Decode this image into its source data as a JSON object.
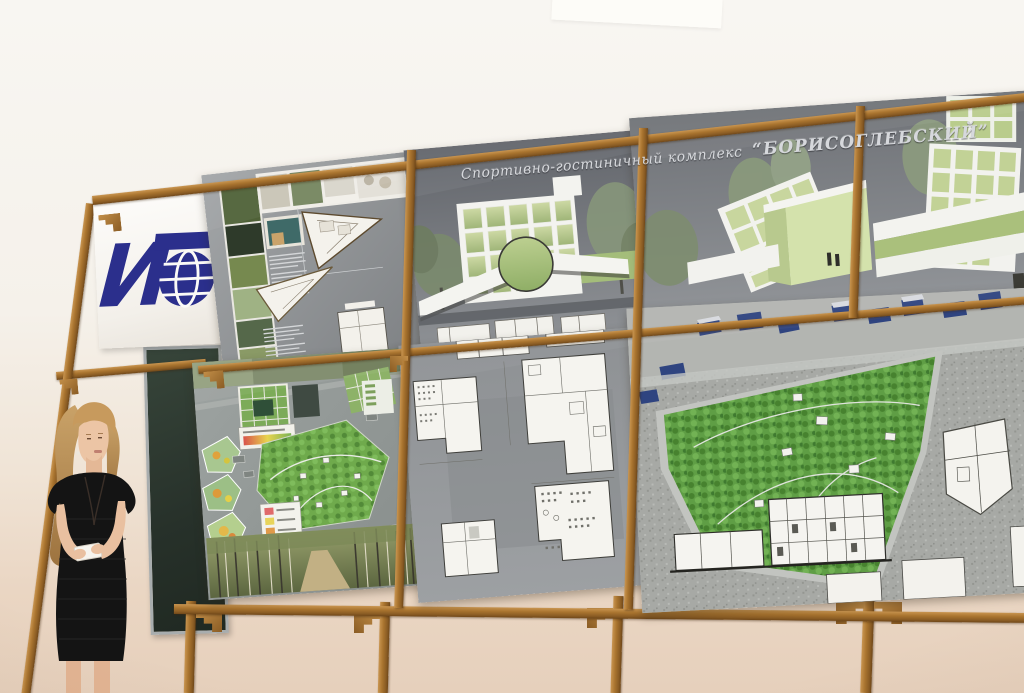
{
  "banner": {
    "title_prefix": "Спортивно-гостиничный комплекс",
    "title_name": "“БОРИСОГЛЕБСКИЙ”"
  },
  "logo": {
    "letter": "И",
    "letters": "ИГ",
    "color": "#2b2f8c"
  },
  "colors": {
    "wood": "#a9742f",
    "wall_top": "#f8f6f2",
    "wall_bottom": "#e6d0bc",
    "board_gray": "#85888c",
    "park_green": "#5f9e45",
    "glass_green": "#c9d79e",
    "chalkboard_green": "#2c362c",
    "logo_blue": "#2b2f8c"
  }
}
